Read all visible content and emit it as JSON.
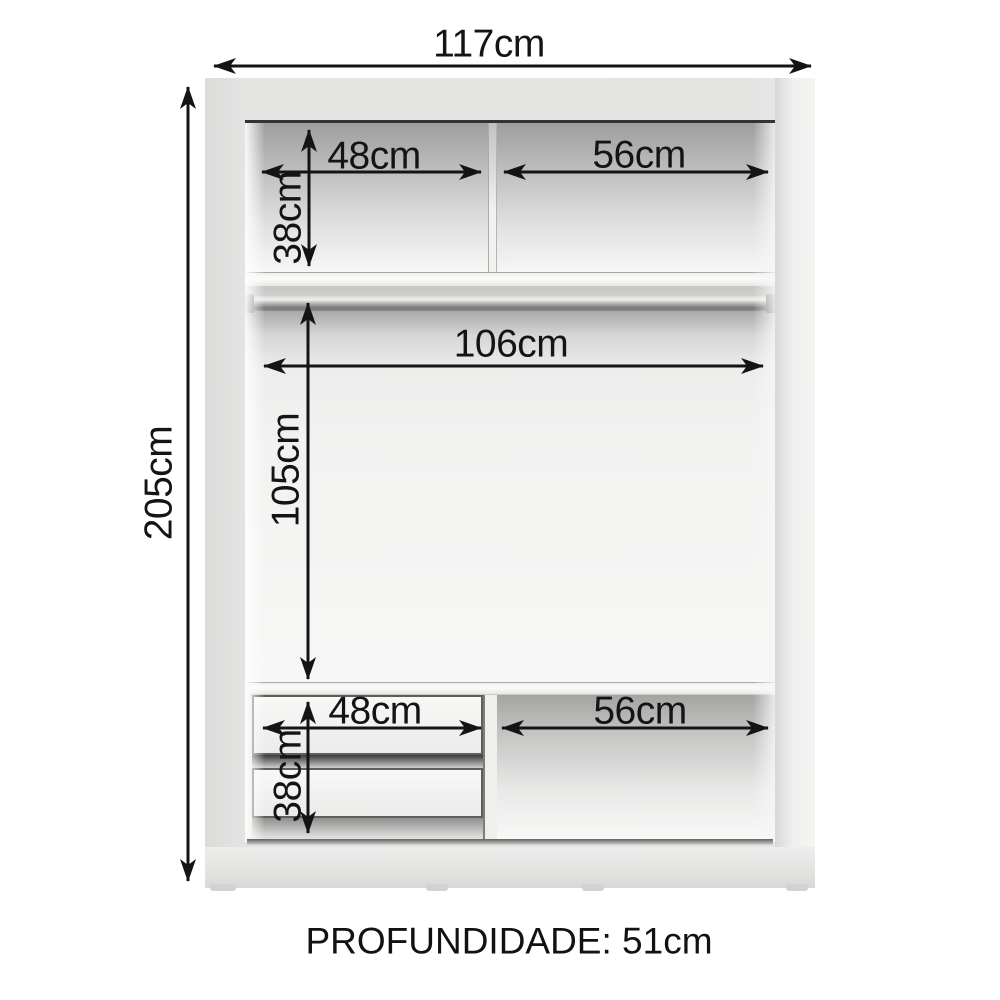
{
  "diagram": {
    "overall": {
      "width_label": "117cm",
      "height_label": "205cm",
      "depth_label": "PROFUNDIDADE: 51cm"
    },
    "top_section": {
      "left_width_label": "48cm",
      "right_width_label": "56cm",
      "height_label": "38cm"
    },
    "hanging_section": {
      "rod_width_label": "106cm",
      "height_label": "105cm"
    },
    "bottom_section": {
      "drawer_width_label": "48cm",
      "right_width_label": "56cm",
      "drawer_height_label": "38cm"
    },
    "measurements": {
      "overall_width_cm": 117,
      "overall_height_cm": 205,
      "depth_cm": 51,
      "top_left_compartment_width_cm": 48,
      "top_right_compartment_width_cm": 56,
      "top_compartment_height_cm": 38,
      "rod_width_cm": 106,
      "hanging_area_height_cm": 105,
      "drawer_width_cm": 48,
      "bottom_right_compartment_width_cm": 56,
      "drawer_stack_height_cm": 38
    },
    "colors": {
      "page_background": "#ffffff",
      "frame": "#e3e3e2",
      "interior_shadow": "#9e9e9e",
      "shelf": "#fbfbfa",
      "rod": "#8d8d8c",
      "dimension_lines": "#141414"
    }
  }
}
